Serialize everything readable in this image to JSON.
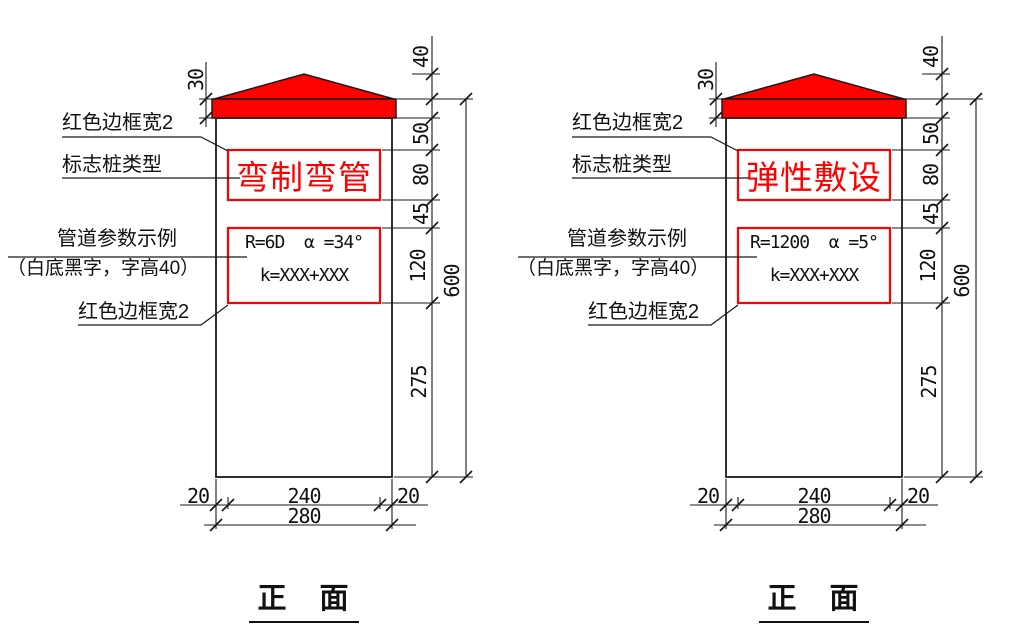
{
  "drawing": {
    "accent_red": "#fe0000",
    "line_color": "#1a1a1a",
    "view_name": "front view"
  },
  "diagrams": [
    {
      "title": "正　面",
      "post_type": "弯制弯管",
      "param_line1": "R=6D  α =34°",
      "param_line2": "k=XXX+XXX",
      "callouts": {
        "red_border_top": "红色边框宽2",
        "post_type_label": "标志桩类型",
        "pipe_params_label": "管道参数示例",
        "pipe_params_note": "（白底黑字，字高40）",
        "red_border_bottom": "红色边框宽2"
      },
      "dims": {
        "band_height": "30",
        "cap_height": "40",
        "gap_top": "50",
        "type_box_height": "80",
        "gap_middle": "45",
        "param_box_height": "120",
        "lower_height": "275",
        "total_height": "600",
        "margin_left": "20",
        "box_width": "240",
        "margin_right": "20",
        "total_width": "280"
      }
    },
    {
      "title": "正　面",
      "post_type": "弹性敷设",
      "param_line1": "R=1200  α =5°",
      "param_line2": "k=XXX+XXX",
      "callouts": {
        "red_border_top": "红色边框宽2",
        "post_type_label": "标志桩类型",
        "pipe_params_label": "管道参数示例",
        "pipe_params_note": "（白底黑字，字高40）",
        "red_border_bottom": "红色边框宽2"
      },
      "dims": {
        "band_height": "30",
        "cap_height": "40",
        "gap_top": "50",
        "type_box_height": "80",
        "gap_middle": "45",
        "param_box_height": "120",
        "lower_height": "275",
        "total_height": "600",
        "margin_left": "20",
        "box_width": "240",
        "margin_right": "20",
        "total_width": "280"
      }
    }
  ]
}
